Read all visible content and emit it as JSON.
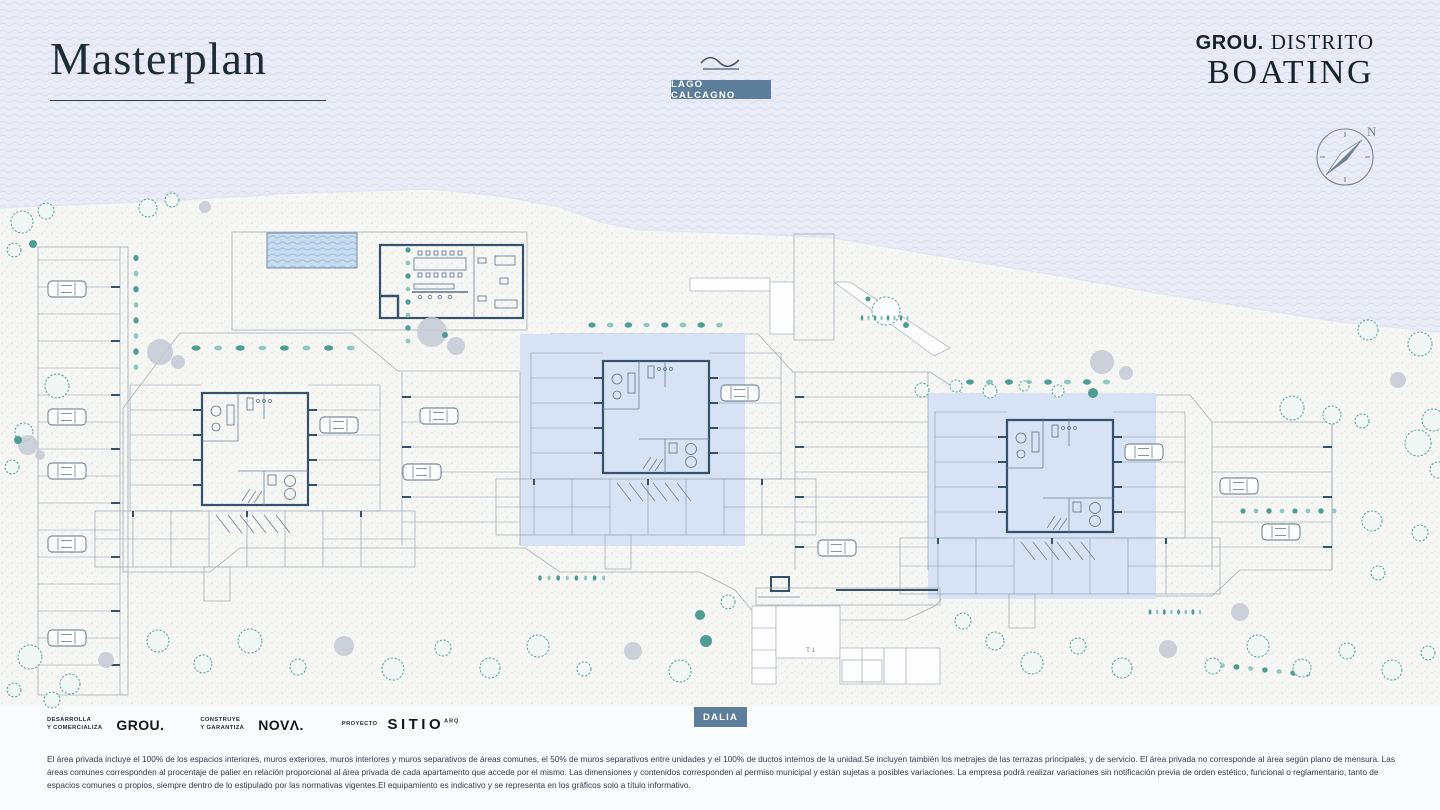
{
  "header": {
    "title": "Masterplan"
  },
  "brand": {
    "name": "GROU.",
    "sub": "DISTRITO",
    "line2": "BOATING"
  },
  "compass": {
    "north_label": "N"
  },
  "map": {
    "lake_label": "LAGO CALCAGNO",
    "building_label": "DALIA",
    "dock_label": "T 1"
  },
  "footer": {
    "partners": [
      {
        "role_lines": [
          "DESARROLLA",
          "Y COMERCIALIZA"
        ],
        "name": "GROU."
      },
      {
        "role_lines": [
          "CONSTRUYE",
          "Y GARANTIZA"
        ],
        "name": "NOVΛ."
      },
      {
        "role_lines": [
          "PROYECTO",
          ""
        ],
        "name": "SITIO",
        "suffix": "ARQ"
      }
    ],
    "disclaimer": "El área privada incluye el 100% de los espacios interiores, muros exteriores, muros interiores y muros separativos de áreas comunes, el 50% de muros separativos entre unidades y el 100% de ductos internos de la unidad.Se incluyen también los metrajes de las terrazas principales, y de servicio. El área privada no corresponde al área según plano de mensura. Las áreas comunes corresponden al procentaje de palier en relación proporcional al área privada de cada apartamento que accede por el mismo. Las dimensiones y contenidos corresponden al permiso municipal y están sujetas a posibles variaciones. La empresa podrá realizar variaciones sin notificación previa de orden estético, funcional o reglamentario, tanto de espacios comunes o propios, siempre dentro de lo estipulado por las normativas vigentes.El equipamiento es indicativo y se representa en los gráficos solo a título informativo."
  },
  "colors": {
    "water": "#e9ecf6",
    "badge_blue": "#5c7e9b",
    "highlight_blue": "#d7e3f4",
    "navy": "#35516b",
    "teal": "#58a096",
    "title_navy": "#1e2b39"
  }
}
